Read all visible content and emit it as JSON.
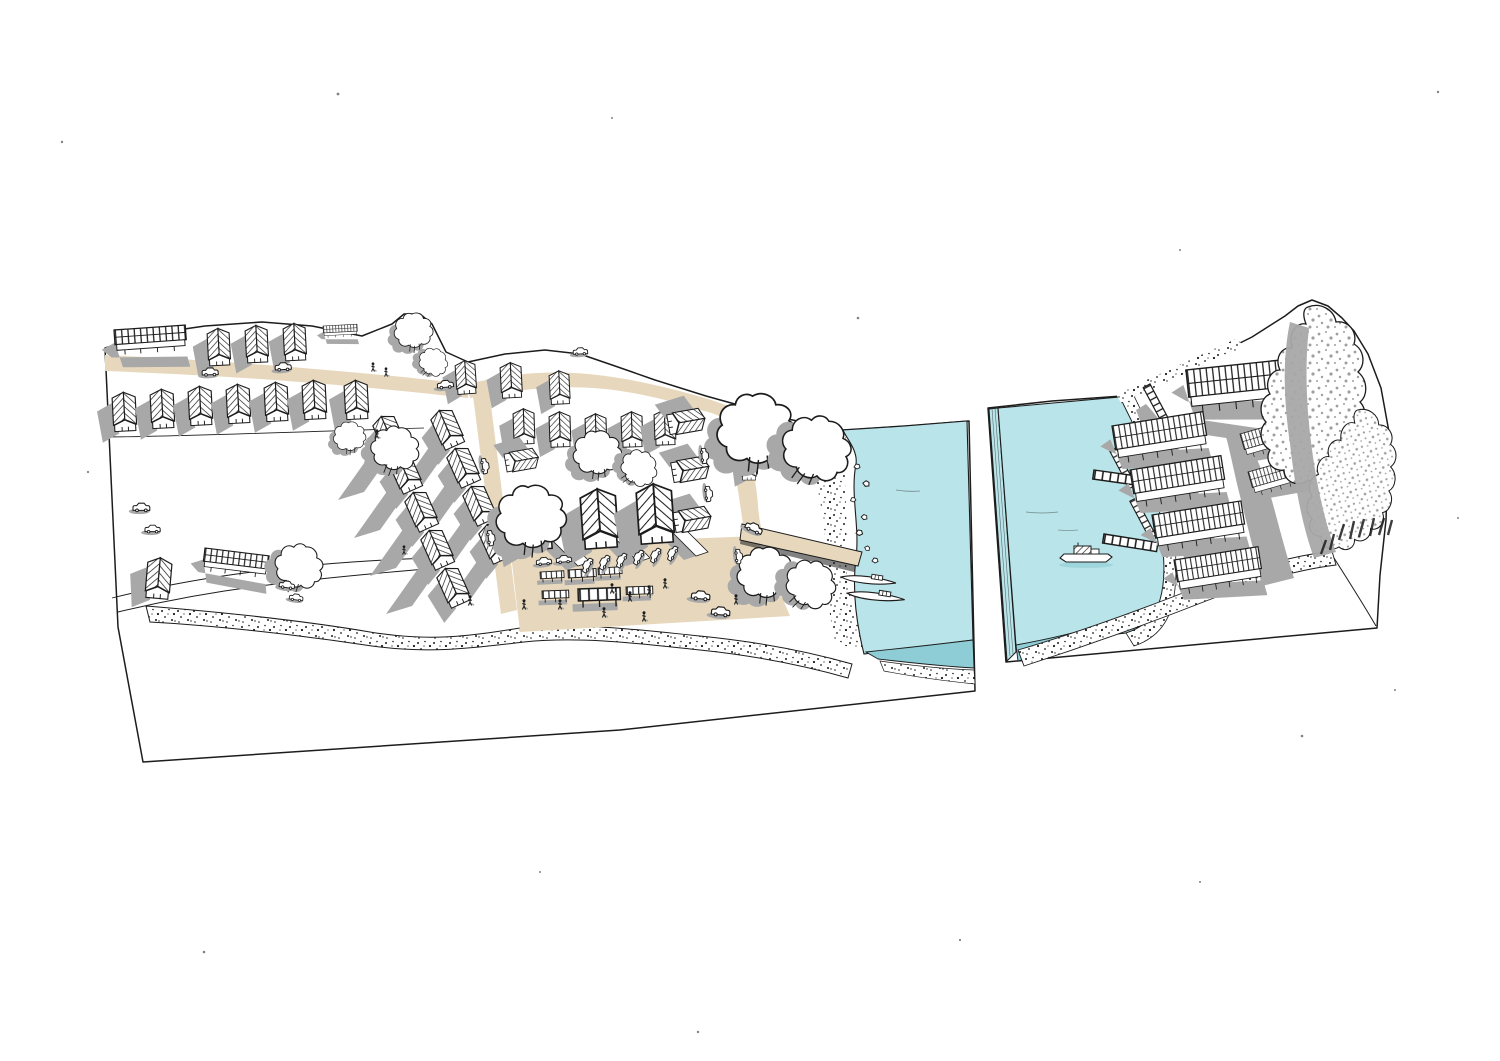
{
  "meta": {
    "type": "hand-drawn axonometric illustration",
    "subject": "Riverside village settlement diagram in two cut-away land blocks with river, jetty, boats, market square and stilt longhouses"
  },
  "palette": {
    "background": "#ffffff",
    "ink": "#1c1c1c",
    "water": "#b9e4e9",
    "water_deep": "#8ecdd5",
    "sand": "#e7d8bd",
    "shadow": "#a8a8a8",
    "speckle": "#9f9f9f"
  },
  "scene": {
    "blocks": [
      {
        "id": "village-block",
        "description": "large land slab with housing rows, roads, market square and jetty"
      },
      {
        "id": "river-block",
        "description": "detached slab with river, moored boat, stilt longhouses, boardwalks and forest"
      }
    ],
    "counts": {
      "houses": 38,
      "longhouses": 13,
      "trees": 14,
      "cars": 24,
      "people": 14,
      "boats": 3,
      "market_stalls": 6
    },
    "layers": [
      {
        "id": "longshadows",
        "symbol": "shadowband",
        "name": "cast-shadow",
        "items": [
          [
            372,
            452,
            1,
            0
          ],
          [
            388,
            490,
            1,
            0
          ],
          [
            404,
            528,
            1,
            0
          ],
          [
            420,
            566,
            1,
            0
          ],
          [
            430,
            446,
            1,
            0
          ],
          [
            446,
            484,
            1,
            0
          ],
          [
            462,
            522,
            1,
            0
          ],
          [
            478,
            560,
            1,
            0
          ]
        ]
      },
      {
        "id": "rocks",
        "symbol": "rock",
        "name": "shoreline-rock",
        "items": [
          [
            854,
            464,
            1,
            0
          ],
          [
            864,
            480,
            1.1,
            20
          ],
          [
            850,
            498,
            0.9,
            -10
          ],
          [
            862,
            514,
            1,
            15
          ],
          [
            856,
            530,
            1.1,
            0
          ],
          [
            866,
            545,
            0.9,
            30
          ],
          [
            872,
            558,
            1,
            0
          ]
        ]
      },
      {
        "id": "houses",
        "symbol": "house",
        "name": "village-house",
        "items": [
          [
            207,
            332,
            1,
            -3
          ],
          [
            245,
            329,
            1,
            -3
          ],
          [
            283,
            327,
            1,
            -3
          ],
          [
            455,
            364,
            0.9,
            -4
          ],
          [
            500,
            366,
            0.95,
            -3
          ],
          [
            549,
            374,
            0.9,
            -3
          ],
          [
            112,
            396,
            1.05,
            -3
          ],
          [
            150,
            393,
            1.05,
            -3
          ],
          [
            188,
            390,
            1.05,
            -3
          ],
          [
            226,
            388,
            1.05,
            -3
          ],
          [
            264,
            386,
            1.05,
            -3
          ],
          [
            302,
            384,
            1.05,
            -3
          ],
          [
            344,
            384,
            1.05,
            -3
          ],
          [
            372,
            424,
            1.05,
            -24
          ],
          [
            388,
            462,
            1.05,
            -24
          ],
          [
            404,
            500,
            1.05,
            -24
          ],
          [
            420,
            538,
            1.05,
            -24
          ],
          [
            436,
            576,
            1.05,
            -24
          ],
          [
            430,
            418,
            1.05,
            -24
          ],
          [
            446,
            456,
            1.05,
            -24
          ],
          [
            462,
            494,
            1.05,
            -24
          ],
          [
            478,
            532,
            1.05,
            -24
          ],
          [
            513,
            412,
            0.95,
            -2
          ],
          [
            549,
            415,
            0.95,
            -2
          ],
          [
            585,
            417,
            0.95,
            -2
          ],
          [
            621,
            415,
            0.95,
            -2
          ],
          [
            654,
            413,
            0.95,
            -2
          ],
          [
            700,
            408,
            1,
            80
          ],
          [
            704,
            456,
            1,
            80
          ],
          [
            706,
            506,
            1,
            80
          ],
          [
            534,
            448,
            0.9,
            80
          ],
          [
            516,
            498,
            1.55,
            -4
          ],
          [
            580,
            495,
            1.6,
            -4
          ],
          [
            636,
            490,
            1.6,
            -4
          ],
          [
            742,
            458,
            0.65,
            0
          ],
          [
            148,
            560,
            1.1,
            5
          ]
        ]
      },
      {
        "id": "barns",
        "symbol": "barn",
        "name": "long-house",
        "items": [
          [
            114,
            330,
            1.05,
            -4
          ],
          [
            323,
            326,
            0.5,
            -3
          ],
          [
            205,
            548,
            0.95,
            7
          ]
        ]
      },
      {
        "id": "trees",
        "symbol": "tree",
        "name": "tree",
        "items": [
          [
            414,
            330,
            0.72,
            0
          ],
          [
            434,
            362,
            0.55,
            40
          ],
          [
            350,
            436,
            0.6,
            0
          ],
          [
            396,
            448,
            0.9,
            15
          ],
          [
            598,
            452,
            0.9,
            0
          ],
          [
            640,
            468,
            0.7,
            50
          ],
          [
            532,
            516,
            1.3,
            0
          ],
          [
            300,
            566,
            0.9,
            25
          ],
          [
            757,
            428,
            1.45,
            0
          ],
          [
            818,
            448,
            1.3,
            30
          ],
          [
            766,
            572,
            1.05,
            0
          ],
          [
            812,
            584,
            0.95,
            40
          ]
        ]
      },
      {
        "id": "stalls",
        "symbol": "stall",
        "name": "market-stall",
        "items": [
          [
            540,
            572,
            0.85,
            -3
          ],
          [
            568,
            570,
            1,
            -3
          ],
          [
            598,
            568,
            0.85,
            -3
          ],
          [
            542,
            591,
            0.95,
            -2
          ],
          [
            578,
            589,
            1.5,
            -2
          ],
          [
            626,
            587,
            0.95,
            -2
          ]
        ]
      },
      {
        "id": "cars",
        "symbol": "car",
        "name": "car",
        "items": [
          [
            202,
            368,
            1,
            -2
          ],
          [
            275,
            363,
            1,
            -3
          ],
          [
            437,
            381,
            1,
            -5
          ],
          [
            573,
            348,
            0.9,
            -3
          ],
          [
            488,
            458,
            0.95,
            82
          ],
          [
            494,
            530,
            0.95,
            82
          ],
          [
            708,
            448,
            0.95,
            85
          ],
          [
            712,
            486,
            0.95,
            85
          ],
          [
            748,
            520,
            1.1,
            25
          ],
          [
            133,
            503,
            1.05,
            0
          ],
          [
            145,
            525,
            0.95,
            0
          ],
          [
            280,
            580,
            0.95,
            8
          ],
          [
            290,
            593,
            0.85,
            8
          ],
          [
            580,
            570,
            0.95,
            -62
          ],
          [
            597,
            567,
            0.95,
            -62
          ],
          [
            614,
            565,
            0.95,
            -62
          ],
          [
            631,
            562,
            0.95,
            -62
          ],
          [
            648,
            560,
            0.95,
            -62
          ],
          [
            665,
            558,
            0.95,
            -62
          ],
          [
            536,
            558,
            0.95,
            -5
          ],
          [
            556,
            556,
            0.95,
            -5
          ],
          [
            742,
            549,
            0.9,
            85
          ],
          [
            692,
            590,
            1.15,
            5
          ],
          [
            712,
            606,
            1.15,
            5
          ]
        ]
      },
      {
        "id": "people",
        "symbol": "person",
        "name": "person",
        "items": [
          [
            612,
            584,
            1,
            0
          ],
          [
            630,
            592,
            1,
            0
          ],
          [
            649,
            586,
            1,
            0
          ],
          [
            665,
            579,
            1,
            0
          ],
          [
            604,
            608,
            1,
            0
          ],
          [
            644,
            612,
            1,
            0
          ],
          [
            560,
            600,
            1,
            0
          ],
          [
            524,
            600,
            1,
            0
          ],
          [
            470,
            596,
            1,
            0
          ],
          [
            736,
            595,
            1,
            0
          ],
          [
            373,
            363,
            0.9,
            0
          ],
          [
            386,
            368,
            0.9,
            0
          ],
          [
            377,
            430,
            0.9,
            0
          ],
          [
            404,
            546,
            0.9,
            0
          ]
        ]
      },
      {
        "id": "canoes",
        "symbol": "canoe",
        "name": "wooden-longboat",
        "items": [
          [
            842,
            572,
            1,
            9
          ],
          [
            848,
            588,
            1.05,
            9
          ]
        ]
      },
      {
        "id": "walkways",
        "symbol": "walkway",
        "name": "boardwalk",
        "items": [
          [
            1150,
            384,
            1.1,
            62
          ],
          [
            1116,
            448,
            1,
            62
          ],
          [
            1136,
            498,
            1,
            62
          ],
          [
            1094,
            470,
            1.3,
            8
          ],
          [
            1104,
            534,
            1.3,
            9
          ]
        ]
      },
      {
        "id": "longhouses",
        "symbol": "longhouse",
        "name": "stilt-longhouse",
        "items": [
          [
            1186,
            370,
            1.05,
            -6
          ],
          [
            1112,
            426,
            0.92,
            -9
          ],
          [
            1130,
            470,
            0.92,
            -9
          ],
          [
            1152,
            515,
            0.9,
            -9
          ],
          [
            1174,
            560,
            0.85,
            -9
          ],
          [
            1240,
            434,
            0.62,
            -16
          ],
          [
            1248,
            472,
            0.62,
            -16
          ]
        ]
      },
      {
        "id": "bigtrees",
        "symbol": "bigtree",
        "name": "forest-tree",
        "items": [
          [
            1316,
            402,
            1,
            0
          ],
          [
            1354,
            486,
            0.8,
            8
          ]
        ]
      },
      {
        "id": "cabinboats",
        "symbol": "cabinboat",
        "name": "river-boat",
        "items": [
          [
            1060,
            550,
            1,
            0
          ]
        ]
      }
    ],
    "specks": [
      [
        62,
        142,
        1.2
      ],
      [
        338,
        94,
        1.4
      ],
      [
        612,
        118,
        1
      ],
      [
        858,
        318,
        1.3
      ],
      [
        1438,
        92,
        1.2
      ],
      [
        1180,
        250,
        1
      ],
      [
        88,
        472,
        1.1
      ],
      [
        204,
        952,
        1.3
      ],
      [
        698,
        1032,
        1.2
      ],
      [
        1200,
        882,
        1
      ],
      [
        1302,
        736,
        1.3
      ],
      [
        1458,
        518,
        1
      ],
      [
        540,
        872,
        1
      ],
      [
        960,
        940,
        1.1
      ],
      [
        1395,
        690,
        1
      ]
    ]
  }
}
